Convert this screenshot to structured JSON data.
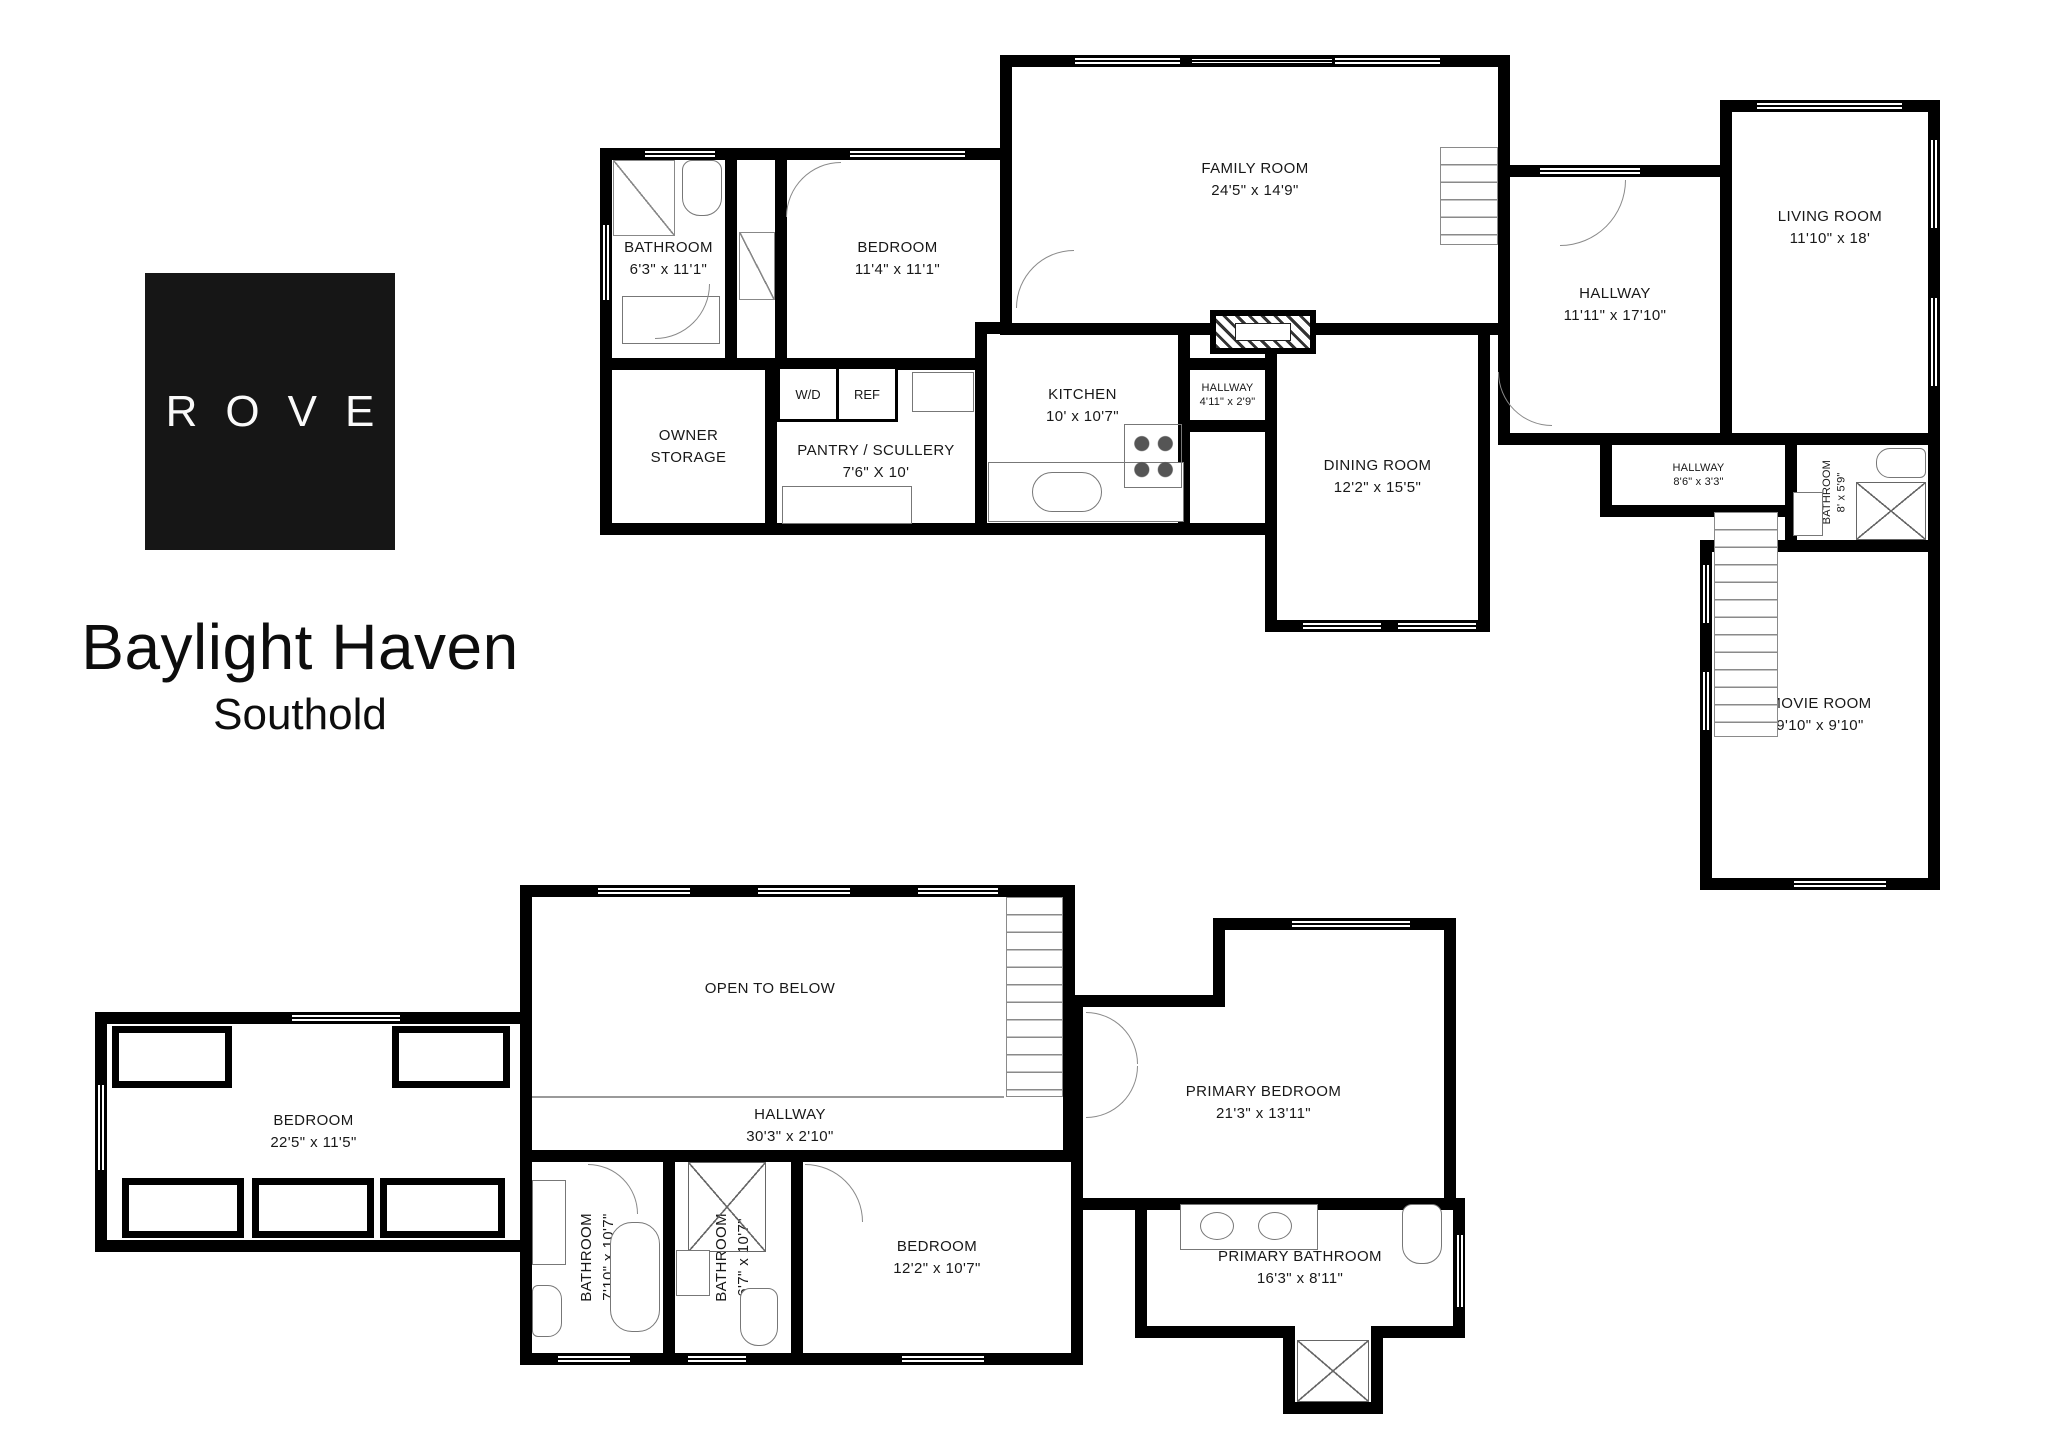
{
  "branding": {
    "logo": "ROVE",
    "title": "Baylight Haven",
    "subtitle": "Southold"
  },
  "colors": {
    "walls": "#000000",
    "background": "#ffffff",
    "logo_background": "#161616",
    "logo_text": "#fafafa",
    "label_text": "#181818"
  },
  "floors": [
    {
      "id": "first-floor",
      "rooms": [
        {
          "name": "BATHROOM",
          "dims": "6'3\" x 11'1\""
        },
        {
          "name": "BEDROOM",
          "dims": "11'4\" x 11'1\""
        },
        {
          "name": "OWNER STORAGE",
          "dims": ""
        },
        {
          "name": "W/D",
          "dims": ""
        },
        {
          "name": "REF",
          "dims": ""
        },
        {
          "name": "PANTRY / SCULLERY",
          "dims": "7'6\" X 10'"
        },
        {
          "name": "KITCHEN",
          "dims": "10' x 10'7\""
        },
        {
          "name": "HALLWAY",
          "dims": "4'11\" x 2'9\""
        },
        {
          "name": "DINING ROOM",
          "dims": "12'2\" x 15'5\""
        },
        {
          "name": "FAMILY ROOM",
          "dims": "24'5\" x 14'9\""
        },
        {
          "name": "HALLWAY",
          "dims": "11'11\" x 17'10\""
        },
        {
          "name": "LIVING ROOM",
          "dims": "11'10\" x 18'"
        },
        {
          "name": "HALLWAY",
          "dims": "8'6\" x 3'3\""
        },
        {
          "name": "BATHROOM",
          "dims": "8' x 5'9\""
        },
        {
          "name": "MOVIE ROOM",
          "dims": "9'10\" x 9'10\""
        }
      ]
    },
    {
      "id": "second-floor",
      "rooms": [
        {
          "name": "BEDROOM",
          "dims": "22'5\" x 11'5\""
        },
        {
          "name": "OPEN TO BELOW",
          "dims": ""
        },
        {
          "name": "HALLWAY",
          "dims": "30'3\" x 2'10\""
        },
        {
          "name": "BATHROOM",
          "dims": "7'10\" x 10'7\""
        },
        {
          "name": "BATHROOM",
          "dims": "6'7\" x 10'7\""
        },
        {
          "name": "BEDROOM",
          "dims": "12'2\" x 10'7\""
        },
        {
          "name": "PRIMARY BEDROOM",
          "dims": "21'3\" x 13'11\""
        },
        {
          "name": "PRIMARY BATHROOM",
          "dims": "16'3\" x 8'11\""
        }
      ]
    }
  ]
}
